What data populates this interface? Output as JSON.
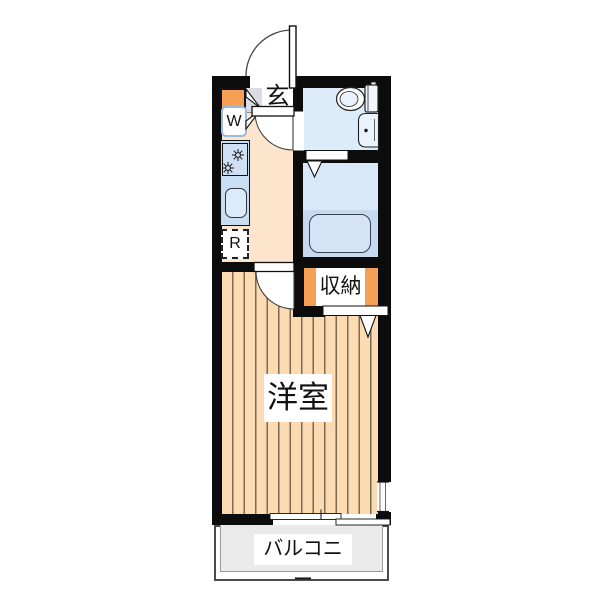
{
  "floorplan": {
    "labels": {
      "entrance": "玄",
      "washer": "W",
      "refrigerator": "R",
      "storage": "収納",
      "western_room": "洋室",
      "balcony": "バルコニー"
    },
    "palette": {
      "wall": "#0c0c0c",
      "kitchen_floor": "#fce5cc",
      "room_plank": "#fcdab2",
      "plank_line": "#7a6b52",
      "genkan_gray": "#dbdce3",
      "toilet_room_blue": "#dcecfb",
      "bath_blue": "#d8e8f8",
      "tub_zone_blue": "#c7d9ef",
      "counter_blue": "#c9ddf3",
      "accent_orange": "#f5a054",
      "balcony_gray": "#eaeaea"
    },
    "icons": {
      "entrance_door": "quarter-circle swing arc",
      "toilet_door": "quarter-circle swing pie",
      "room_door": "quarter-circle swing pie",
      "bath_folding_door": "V fold symbol",
      "storage_folding_door": "V fold symbol",
      "shoe_cabinet_bifold": "double triangle fold symbol",
      "stove": "two asterisk burners",
      "toilet": "bowl with tank",
      "bathroom_sink": "rounded basin with faucet dot",
      "bathtub": "rounded rectangle tub",
      "sliding_window": "offset double bars",
      "side_window": "double line gap in wall"
    }
  }
}
